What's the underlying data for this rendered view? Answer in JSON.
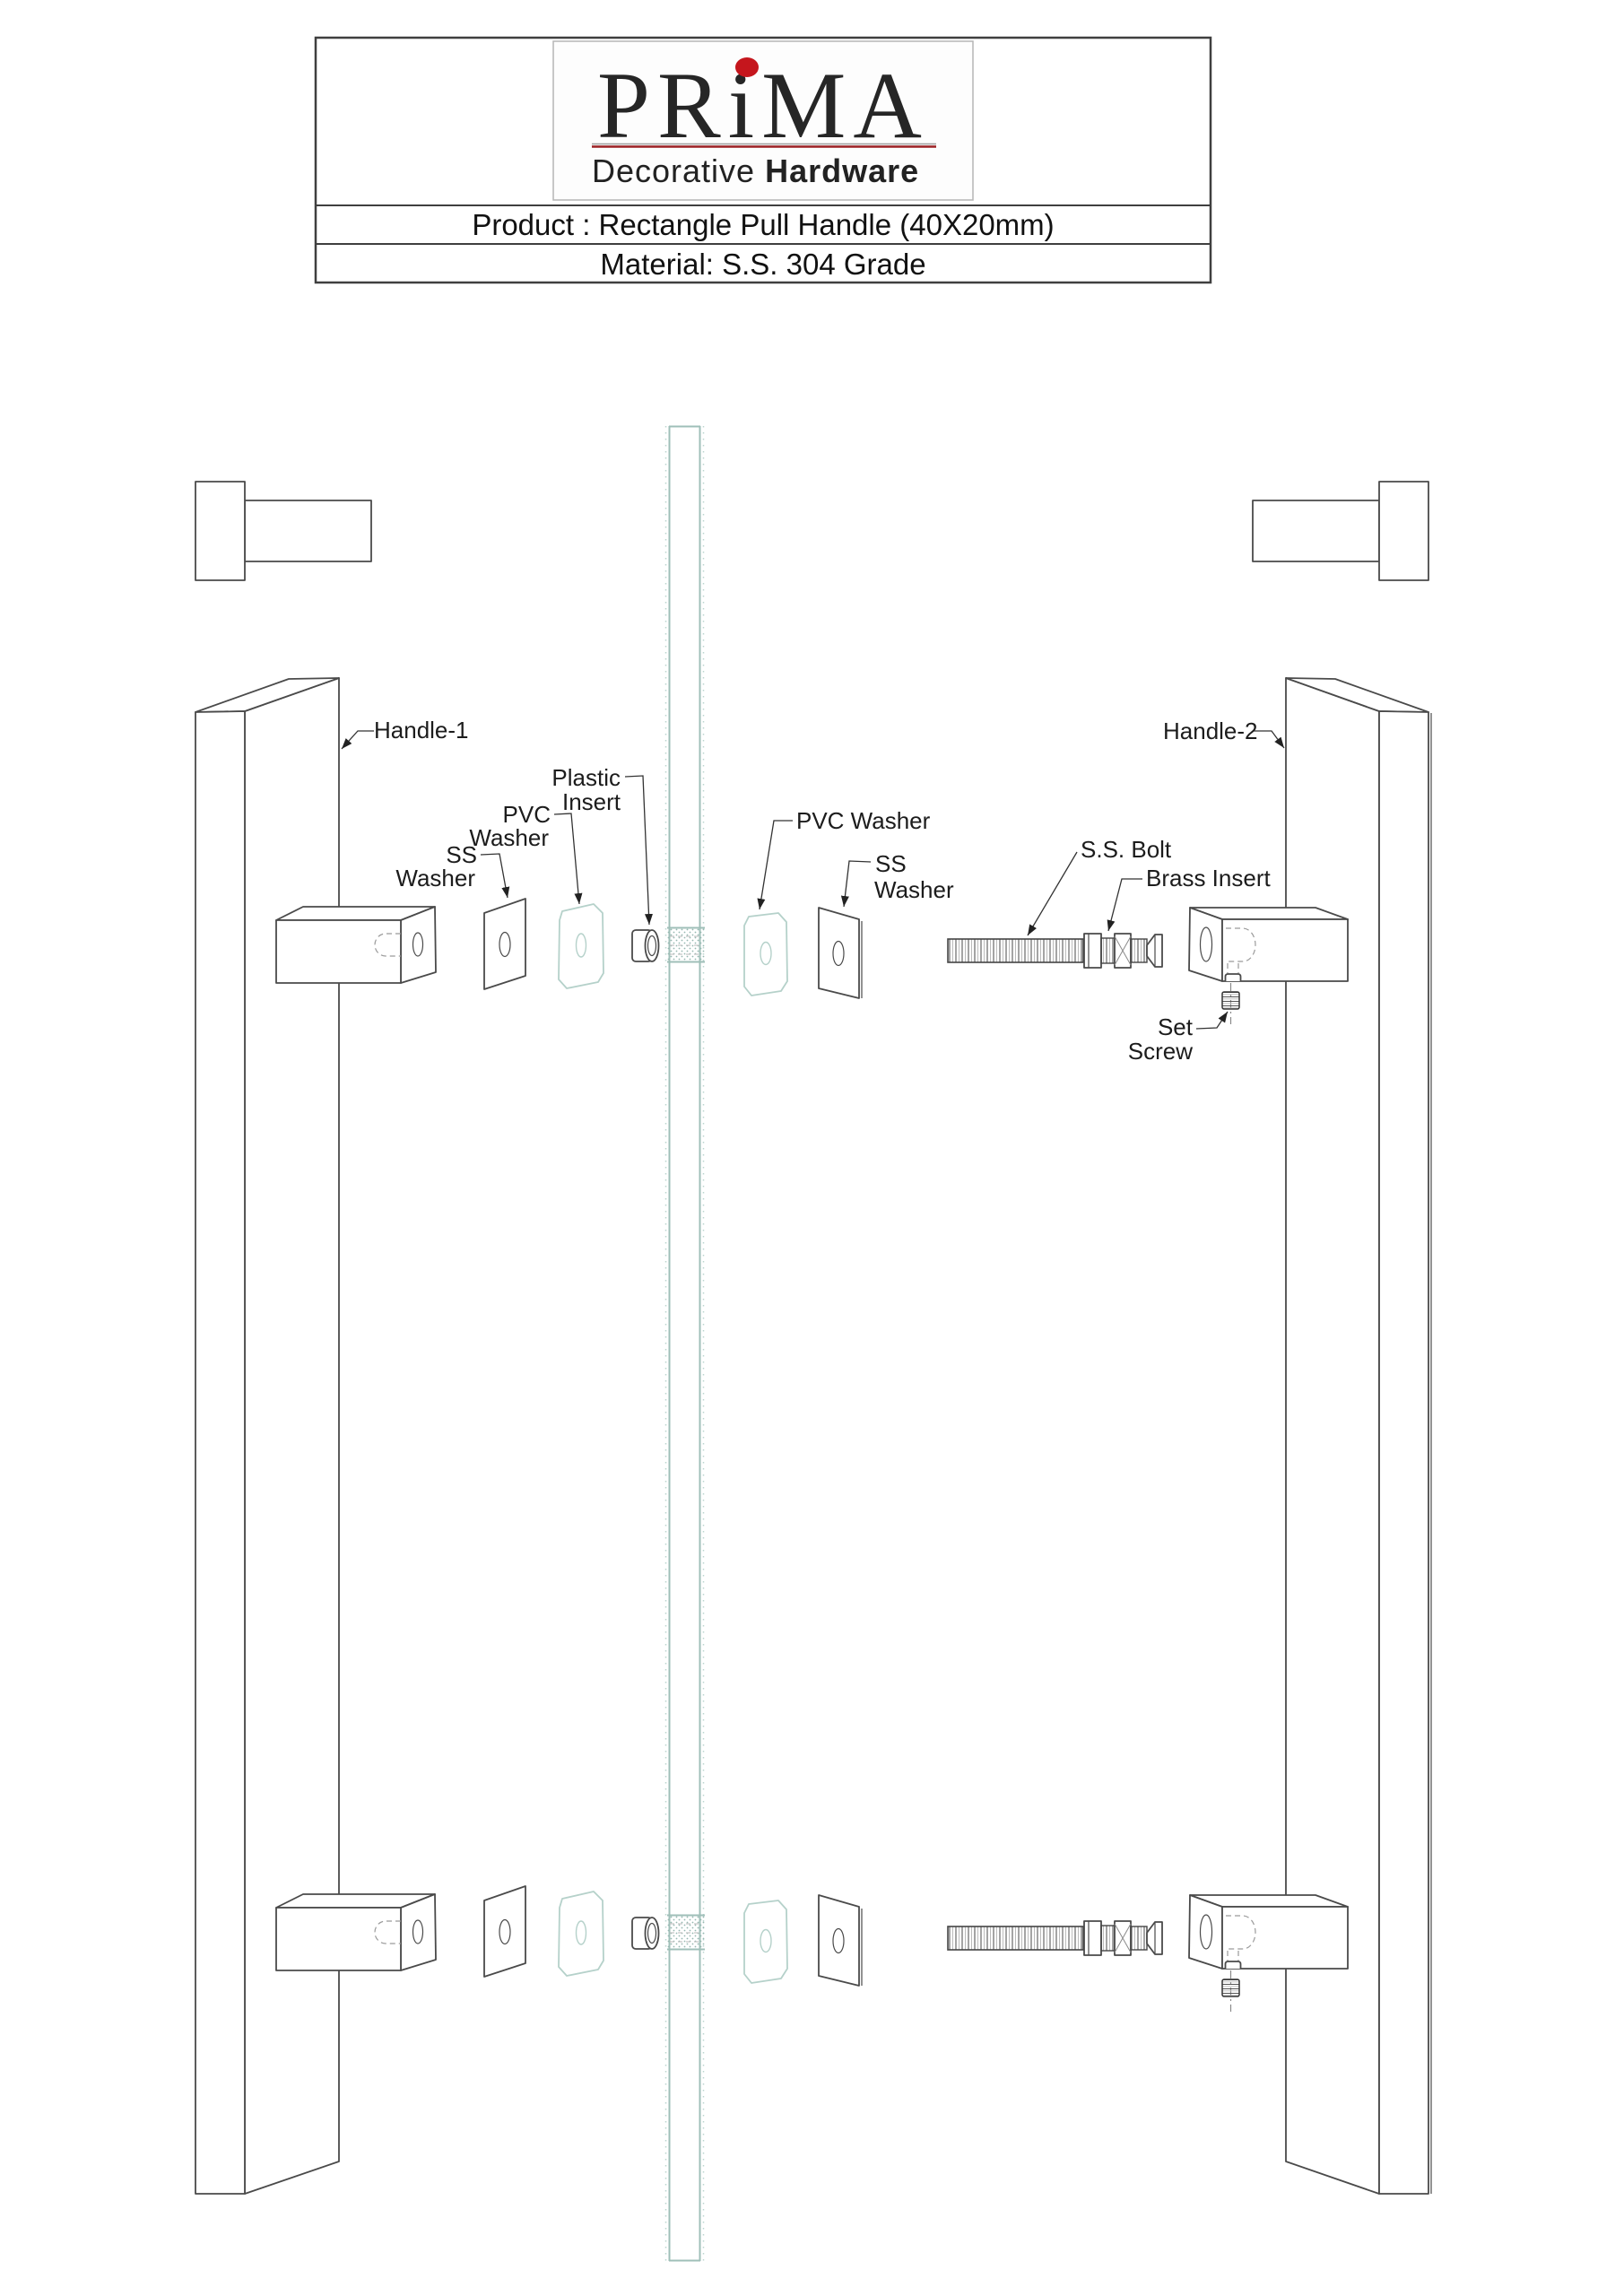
{
  "title_block": {
    "logo": {
      "brand": "PRiMA",
      "tagline_regular": "Decorative ",
      "tagline_bold": "Hardware"
    },
    "product_row": "Product : Rectangle Pull Handle (40X20mm)",
    "material_row": "Material: S.S. 304 Grade"
  },
  "callouts": {
    "handle_1": "Handle-1",
    "handle_2": "Handle-2",
    "plastic_insert": {
      "line1": "Plastic",
      "line2": "Insert"
    },
    "pvc_washer_left": {
      "line1": "PVC",
      "line2": "Washer"
    },
    "ss_washer_left": {
      "line1": "SS",
      "line2": "Washer"
    },
    "pvc_washer_right": "PVC Washer",
    "ss_washer_right": {
      "line1": "SS",
      "line2": "Washer"
    },
    "ss_bolt": "S.S. Bolt",
    "brass_insert": "Brass Insert",
    "set_screw": {
      "line1": "Set",
      "line2": "Screw"
    }
  },
  "colors": {
    "glass_teal": "#9fbfb8",
    "logo_dot_red": "#c5161d",
    "logo_underline_red": "#9b2023",
    "drawing_line": "#4a4a4a"
  }
}
